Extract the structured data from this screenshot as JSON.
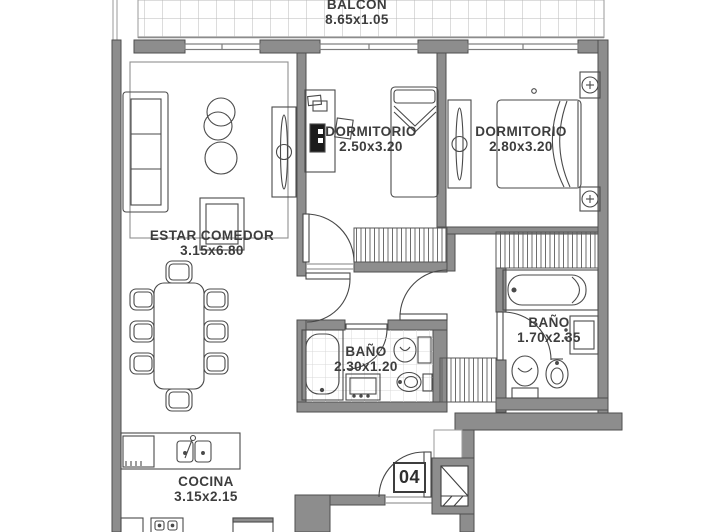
{
  "title": "Apartment floor plan",
  "unit": {
    "number": "04"
  },
  "colors": {
    "wall": "#8d8d8d",
    "wall_outline": "#4e4e4e",
    "furniture_line": "#474747",
    "balcony_grid": "#b8b8b8",
    "background": "#ffffff"
  },
  "rooms": {
    "balcon": {
      "name": "BALCON",
      "dims": "8.65x1.05"
    },
    "estar_comedor": {
      "name": "ESTAR COMEDOR",
      "dims": "3.15x6.80",
      "fixtures": [
        "sofa",
        "side-tables",
        "tv-unit",
        "armchair",
        "dining-table",
        "eight-chairs"
      ]
    },
    "dormitorio1": {
      "name": "DORMITORIO",
      "dims": "2.50x3.20",
      "fixtures": [
        "desk",
        "computer",
        "desk-chair",
        "single-bed",
        "closet"
      ]
    },
    "dormitorio2": {
      "name": "DORMITORIO",
      "dims": "2.80x3.20",
      "fixtures": [
        "wardrobe",
        "double-bed",
        "nightstand",
        "nightstand",
        "closet"
      ]
    },
    "bano_interno": {
      "name": "BAÑO",
      "dims": "2.30x1.20",
      "fixtures": [
        "bathtub",
        "vanity-sink",
        "toilet",
        "bidet"
      ]
    },
    "bano_suite": {
      "name": "BAÑO",
      "dims": "1.70x2.35",
      "fixtures": [
        "bathtub",
        "vanity-sink",
        "toilet",
        "bidet"
      ]
    },
    "cocina": {
      "name": "COCINA",
      "dims": "3.15x2.15",
      "fixtures": [
        "counter",
        "double-sink",
        "fridge",
        "stove",
        "dishwasher"
      ]
    }
  },
  "features": {
    "entry_door": "door-04",
    "service_shaft": "shaft-x-symbol"
  }
}
